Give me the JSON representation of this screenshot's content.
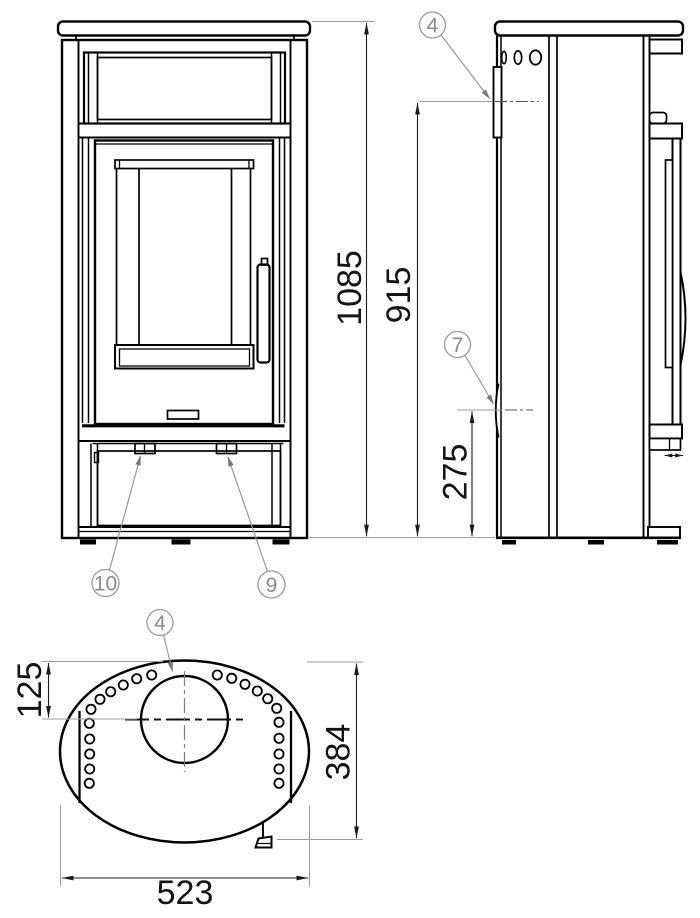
{
  "drawing": {
    "dimensions": {
      "overall_height": "1085",
      "rear_flue_height": "915",
      "air_inlet_height": "275",
      "flue_offset_depth": "125",
      "body_depth": "384",
      "body_width": "523"
    },
    "callouts": {
      "flue_outlet_side": "4",
      "flue_outlet_top": "4",
      "air_inlet": "7",
      "latch_right": "9",
      "latch_left": "10"
    }
  }
}
